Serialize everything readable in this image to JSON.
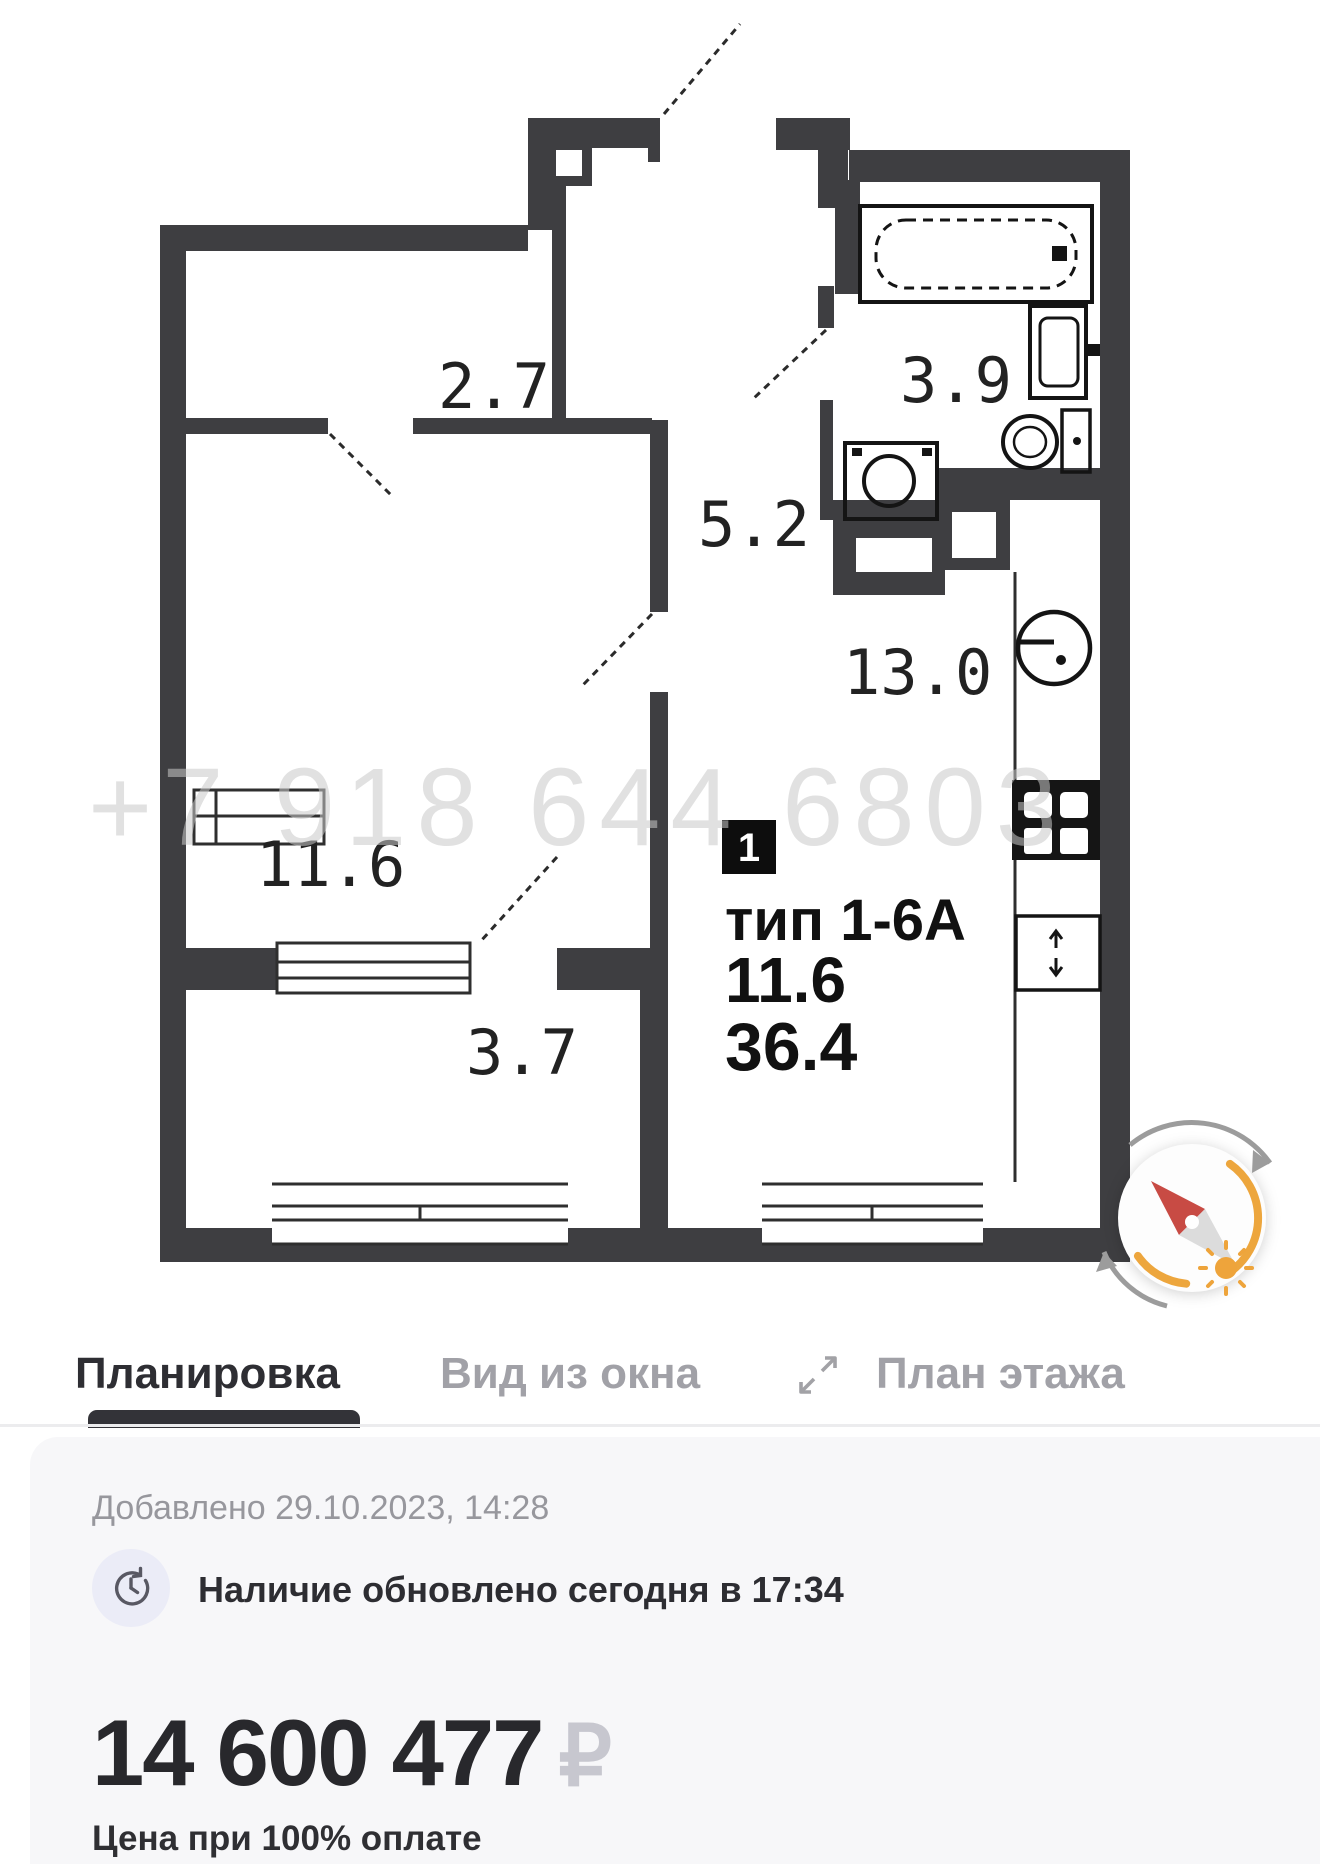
{
  "plan": {
    "watermark": "+7 918 644 6803",
    "rooms": [
      {
        "name": "hallway",
        "area": "2.7"
      },
      {
        "name": "bathroom",
        "area": "3.9"
      },
      {
        "name": "corridor",
        "area": "5.2"
      },
      {
        "name": "kitchen-living",
        "area": "13.0"
      },
      {
        "name": "room",
        "area": "11.6"
      },
      {
        "name": "balcony",
        "area": "3.7"
      }
    ],
    "unit": {
      "badge": "1",
      "type": "тип 1-6А",
      "living_area": "11.6",
      "total_area": "36.4"
    }
  },
  "tabs": [
    {
      "label": "Планировка",
      "active": true
    },
    {
      "label": "Вид из окна",
      "active": false
    },
    {
      "label": "План этажа",
      "active": false
    }
  ],
  "card": {
    "added": "Добавлено 29.10.2023, 14:28",
    "availability": "Наличие обновлено сегодня в 17:34",
    "price": "14 600 477",
    "currency": "₽",
    "price_note": "Цена при 100% оплате"
  },
  "colors": {
    "wall": "#3e3e41",
    "accent_orange": "#eda63d",
    "needle_red": "#c84b44",
    "tab_active": "#2e2e33",
    "tab_inactive": "#a1a1a7",
    "card_bg": "#f7f7f9"
  }
}
